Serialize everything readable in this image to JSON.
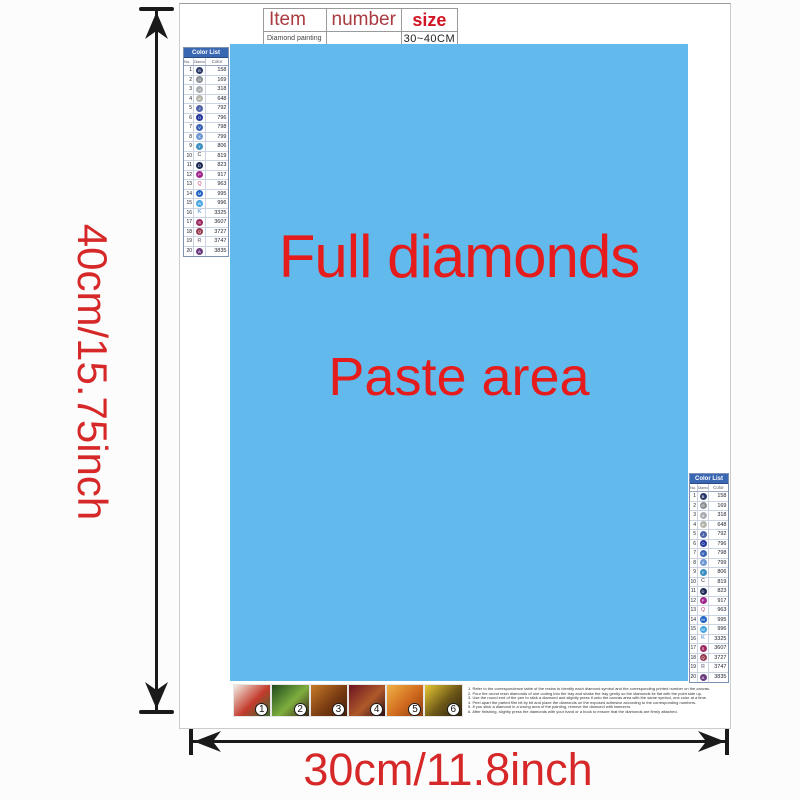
{
  "dimensions": {
    "height_label": "40cm/15.75inch",
    "width_label": "30cm/11.8inch"
  },
  "item_table": {
    "headers": [
      {
        "label": "Item"
      },
      {
        "label": "number"
      },
      {
        "label": "size"
      }
    ],
    "row": {
      "item": "Diamond painting",
      "number": "",
      "size": "30~40CM"
    }
  },
  "paste_area": {
    "line1": "Full diamonds",
    "line2": "Paste area",
    "bg": "#62b9ec",
    "text_color": "#e61c1c"
  },
  "color_list": {
    "title": "Color List",
    "columns": [
      "No.",
      "Diamond",
      "Color"
    ],
    "header_bg": "#3a67b2",
    "rows": [
      {
        "no": "1",
        "symbol": "B",
        "type": "circle",
        "fill": "#2b3a6b",
        "code": "158"
      },
      {
        "no": "2",
        "symbol": "G",
        "type": "circle",
        "fill": "#8a8f94",
        "code": "169"
      },
      {
        "no": "3",
        "symbol": "d",
        "type": "circle",
        "fill": "#a9adb2",
        "code": "318"
      },
      {
        "no": "4",
        "symbol": "e",
        "type": "circle",
        "fill": "#b4b6ab",
        "code": "648"
      },
      {
        "no": "5",
        "symbol": "J",
        "type": "circle",
        "fill": "#4d62a8",
        "code": "792"
      },
      {
        "no": "6",
        "symbol": "O",
        "type": "circle",
        "fill": "#22369b",
        "code": "796"
      },
      {
        "no": "7",
        "symbol": "V",
        "type": "circle",
        "fill": "#3c64b5",
        "code": "798"
      },
      {
        "no": "8",
        "symbol": "X",
        "type": "circle",
        "fill": "#6f97d2",
        "code": "799"
      },
      {
        "no": "9",
        "symbol": "Y",
        "type": "circle",
        "fill": "#3a8fc0",
        "code": "806"
      },
      {
        "no": "10",
        "symbol": "C",
        "type": "letter",
        "fill": "#777777",
        "code": "819"
      },
      {
        "no": "11",
        "symbol": "D",
        "type": "circle",
        "fill": "#1c2b55",
        "code": "823"
      },
      {
        "no": "12",
        "symbol": "P",
        "type": "circle",
        "fill": "#a0268d",
        "code": "917"
      },
      {
        "no": "13",
        "symbol": "Q",
        "type": "letter",
        "fill": "#d8809f",
        "code": "963"
      },
      {
        "no": "14",
        "symbol": "M",
        "type": "circle",
        "fill": "#2061c4",
        "code": "995"
      },
      {
        "no": "15",
        "symbol": "W",
        "type": "circle",
        "fill": "#45a5e0",
        "code": "996"
      },
      {
        "no": "16",
        "symbol": "K",
        "type": "letter",
        "fill": "#74a6d6",
        "code": "3325"
      },
      {
        "no": "17",
        "symbol": "S",
        "type": "circle",
        "fill": "#9c2a60",
        "code": "3607"
      },
      {
        "no": "18",
        "symbol": "Q",
        "type": "circle",
        "fill": "#963a50",
        "code": "3727"
      },
      {
        "no": "19",
        "symbol": "R",
        "type": "letter",
        "fill": "#8b8b9d",
        "code": "3747"
      },
      {
        "no": "20",
        "symbol": "A",
        "type": "circle",
        "fill": "#6b3d7e",
        "code": "3835"
      }
    ]
  },
  "steps": {
    "items": [
      {
        "num": "1",
        "c1": "#f2eee6",
        "c2": "#c33b2c",
        "c3": "#3a6b2e"
      },
      {
        "num": "2",
        "c1": "#1e4a1c",
        "c2": "#7fae3f",
        "c3": "#3a2414"
      },
      {
        "num": "3",
        "c1": "#c77a26",
        "c2": "#7a3c12",
        "c3": "#46200c"
      },
      {
        "num": "4",
        "c1": "#6b1422",
        "c2": "#b05a2a",
        "c3": "#2e0d14"
      },
      {
        "num": "5",
        "c1": "#f0b244",
        "c2": "#d06a1e",
        "c3": "#8a3c12"
      },
      {
        "num": "6",
        "c1": "#e6c832",
        "c2": "#6b5618",
        "c3": "#2c2410"
      }
    ]
  },
  "instructions": {
    "lines": [
      "1. Refer to the correspondence table of the resins to identify each diamond symbol and the corresponding printed number on the canvas.",
      "2. Pour the round resin diamonds of one coding into the tray and shake the tray gently so the diamonds lie flat with the point side up.",
      "3. Use the round end of the pen to stick a diamond and slightly press it onto the canvas area with the same symbol, one color at a time.",
      "4. Peel apart the parted film bit by bit and place the diamonds on the exposed adhesive according to the corresponding numbers.",
      "5. If you stick a diamond in a wrong area of the painting, remove the diamond with tweezers.",
      "6. After finishing, slightly press the diamonds with your hand or a book to ensure that the diamonds are firmly attached."
    ]
  }
}
